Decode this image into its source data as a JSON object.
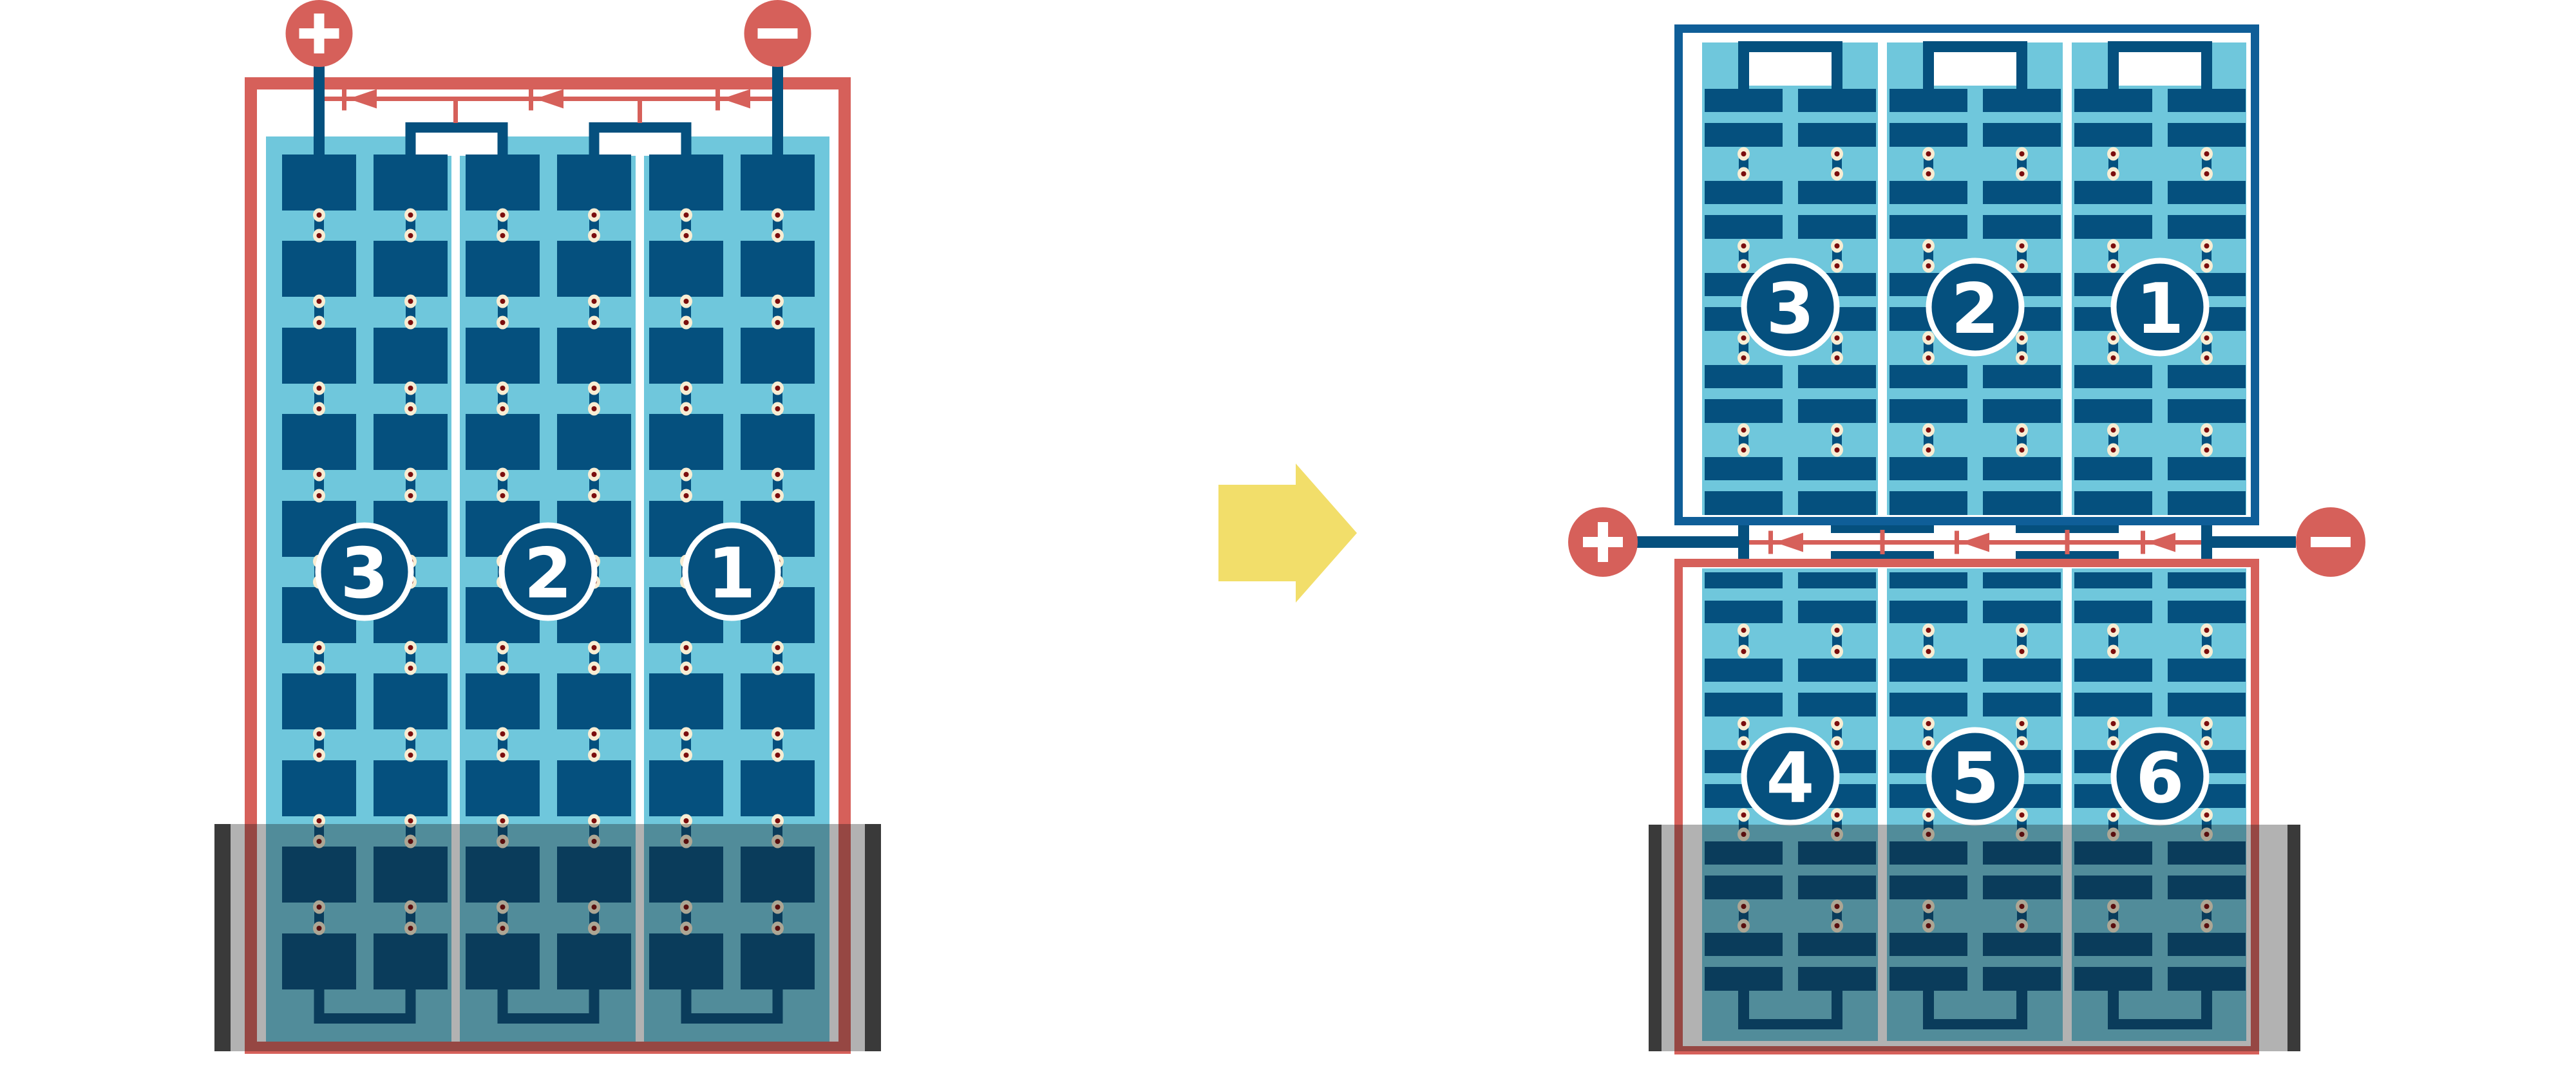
{
  "colors": {
    "red": "#D6605A",
    "cell_blue": "#05507E",
    "frame_blue": "#0F5E98",
    "light_blue": "#6FC7DC",
    "solder_ring": "#F8EDD3",
    "solder_core": "#7B0D0D",
    "arrow_yellow": "#F2DE6A",
    "flood_edge": "#3A3A3A",
    "flood_overlay": "rgba(20,20,20,0.33)",
    "badge_ring": "#FFFFFF",
    "badge_text": "#FFFFFF",
    "background": "#FFFFFF"
  },
  "left_panel": {
    "terminals": {
      "positive_label": "+",
      "negative_label": "−"
    },
    "substring_badges": [
      "3",
      "2",
      "1"
    ],
    "substring_count": 3,
    "cell_columns": 6,
    "cell_rows": 10,
    "bypass_diode_count": 3
  },
  "transform_arrow": {
    "direction": "right"
  },
  "right_top_panel": {
    "substring_badges": [
      "3",
      "2",
      "1"
    ],
    "substring_count": 3,
    "cell_columns": 6
  },
  "right_bottom_panel": {
    "substring_badges": [
      "4",
      "5",
      "6"
    ],
    "substring_count": 3,
    "cell_columns": 6
  },
  "junction": {
    "terminals": {
      "positive_label": "+",
      "negative_label": "−"
    },
    "bypass_diode_count": 3
  }
}
